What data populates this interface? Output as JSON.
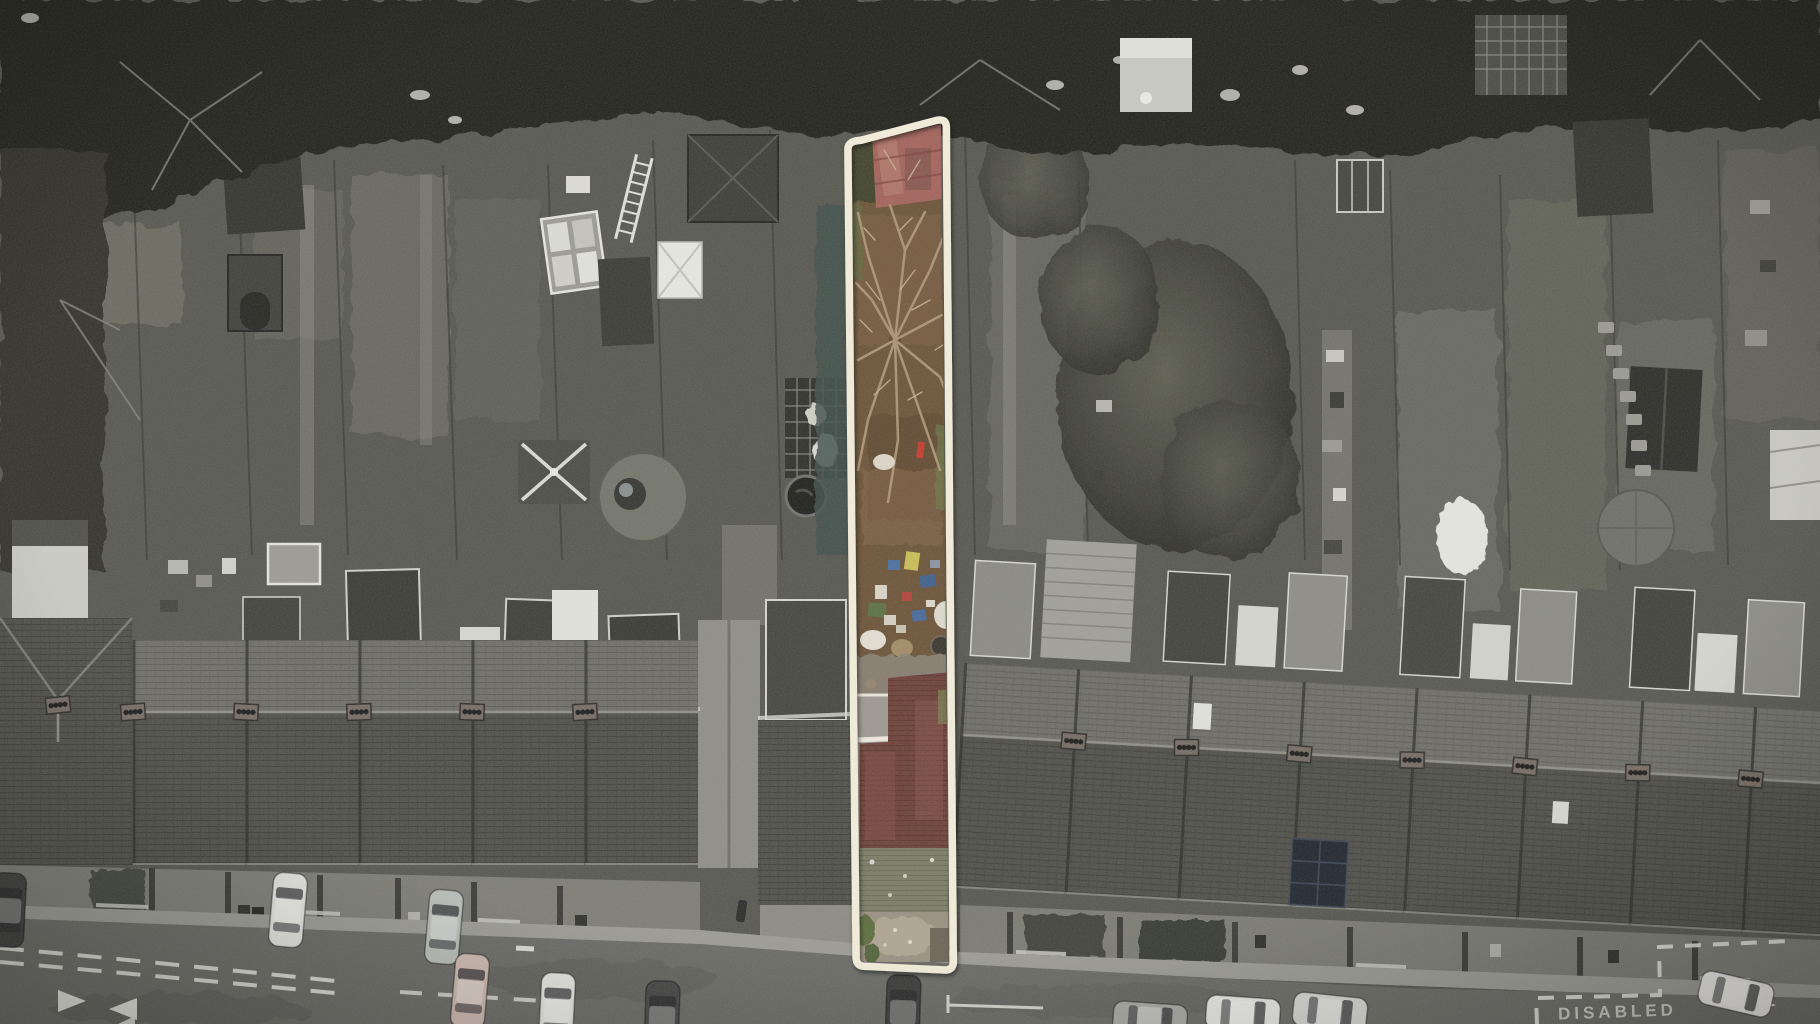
{
  "road": {
    "disabled_bay_label": "DISABLED"
  },
  "highlight": {
    "outline_color": "#f4eedb"
  },
  "palette": {
    "woodland": "#23241f",
    "garden_base": "#56574f",
    "road": "#6a6a65",
    "pavement": "#9b9b94",
    "roof_rear": "#6e6e67",
    "roof_front": "#4f4f49",
    "plot_earth": "#6b5337",
    "plot_shed_roof": "#a2625a",
    "plot_house_roof": "#6d4038",
    "plot_moss_roof": "#7b7c66",
    "car_white": "#e4e4e0",
    "car_dark": "#3a3a38"
  }
}
